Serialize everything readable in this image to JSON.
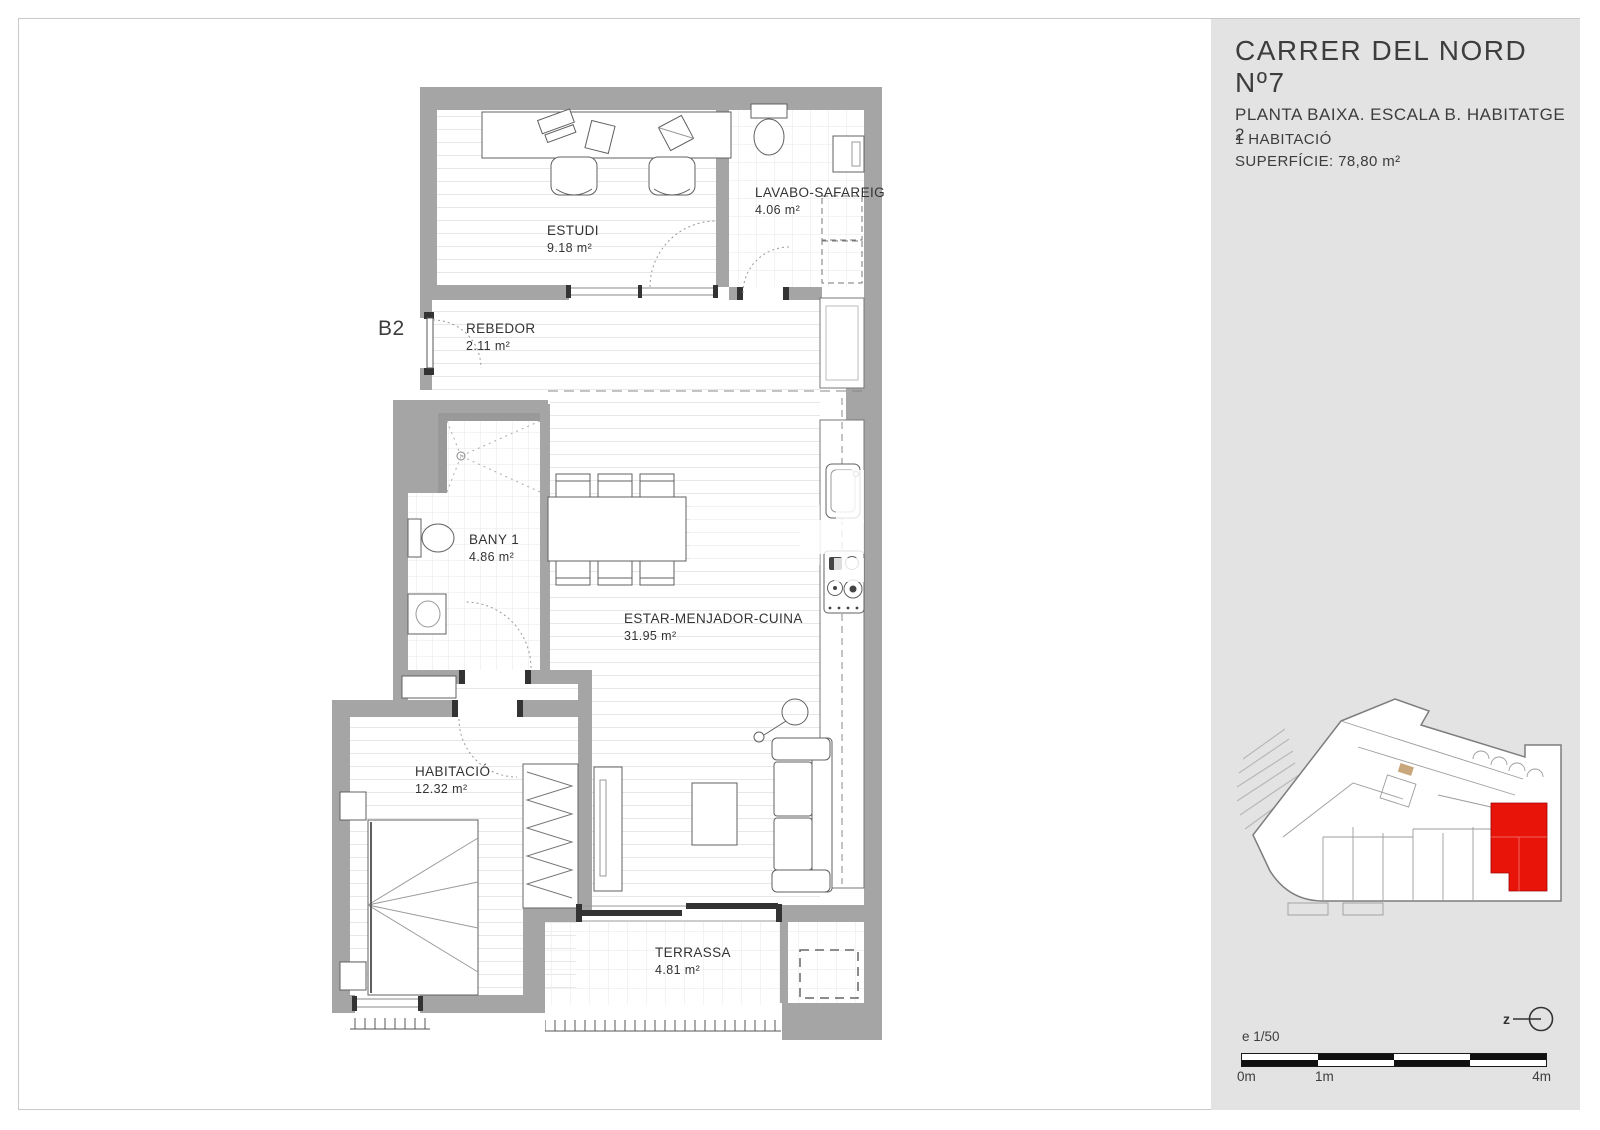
{
  "document": {
    "bg_color": "#ffffff",
    "frame_color": "#c9c9c9"
  },
  "plan": {
    "wall_color": "#a5a5a5",
    "unit_label": "B2",
    "rooms": [
      {
        "name": "ESTUDI",
        "area": "9.18 m²"
      },
      {
        "name": "LAVABO-SAFAREIG",
        "area": "4.06 m²"
      },
      {
        "name": "REBEDOR",
        "area": "2.11 m²"
      },
      {
        "name": "BANY 1",
        "area": "4.86 m²"
      },
      {
        "name": "ESTAR-MENJADOR-CUINA",
        "area": "31.95 m²"
      },
      {
        "name": "HABITACIÓ",
        "area": "12.32 m²"
      },
      {
        "name": "TERRASSA",
        "area": "4.81 m²"
      }
    ]
  },
  "sidebar": {
    "bg_color": "#e3e3e3",
    "title": "CARRER DEL NORD Nº7",
    "subtitle": "PLANTA BAIXA. ESCALA B. HABITATGE 2",
    "detail_rooms": "1 HABITACIÓ",
    "detail_area": "SUPERFÍCIE: 78,80 m²",
    "map_highlight_color": "#e81309",
    "north_label": "z",
    "scale_note": "e 1/50",
    "scale_start": "0m",
    "scale_mid": "1m",
    "scale_end": "4m"
  }
}
